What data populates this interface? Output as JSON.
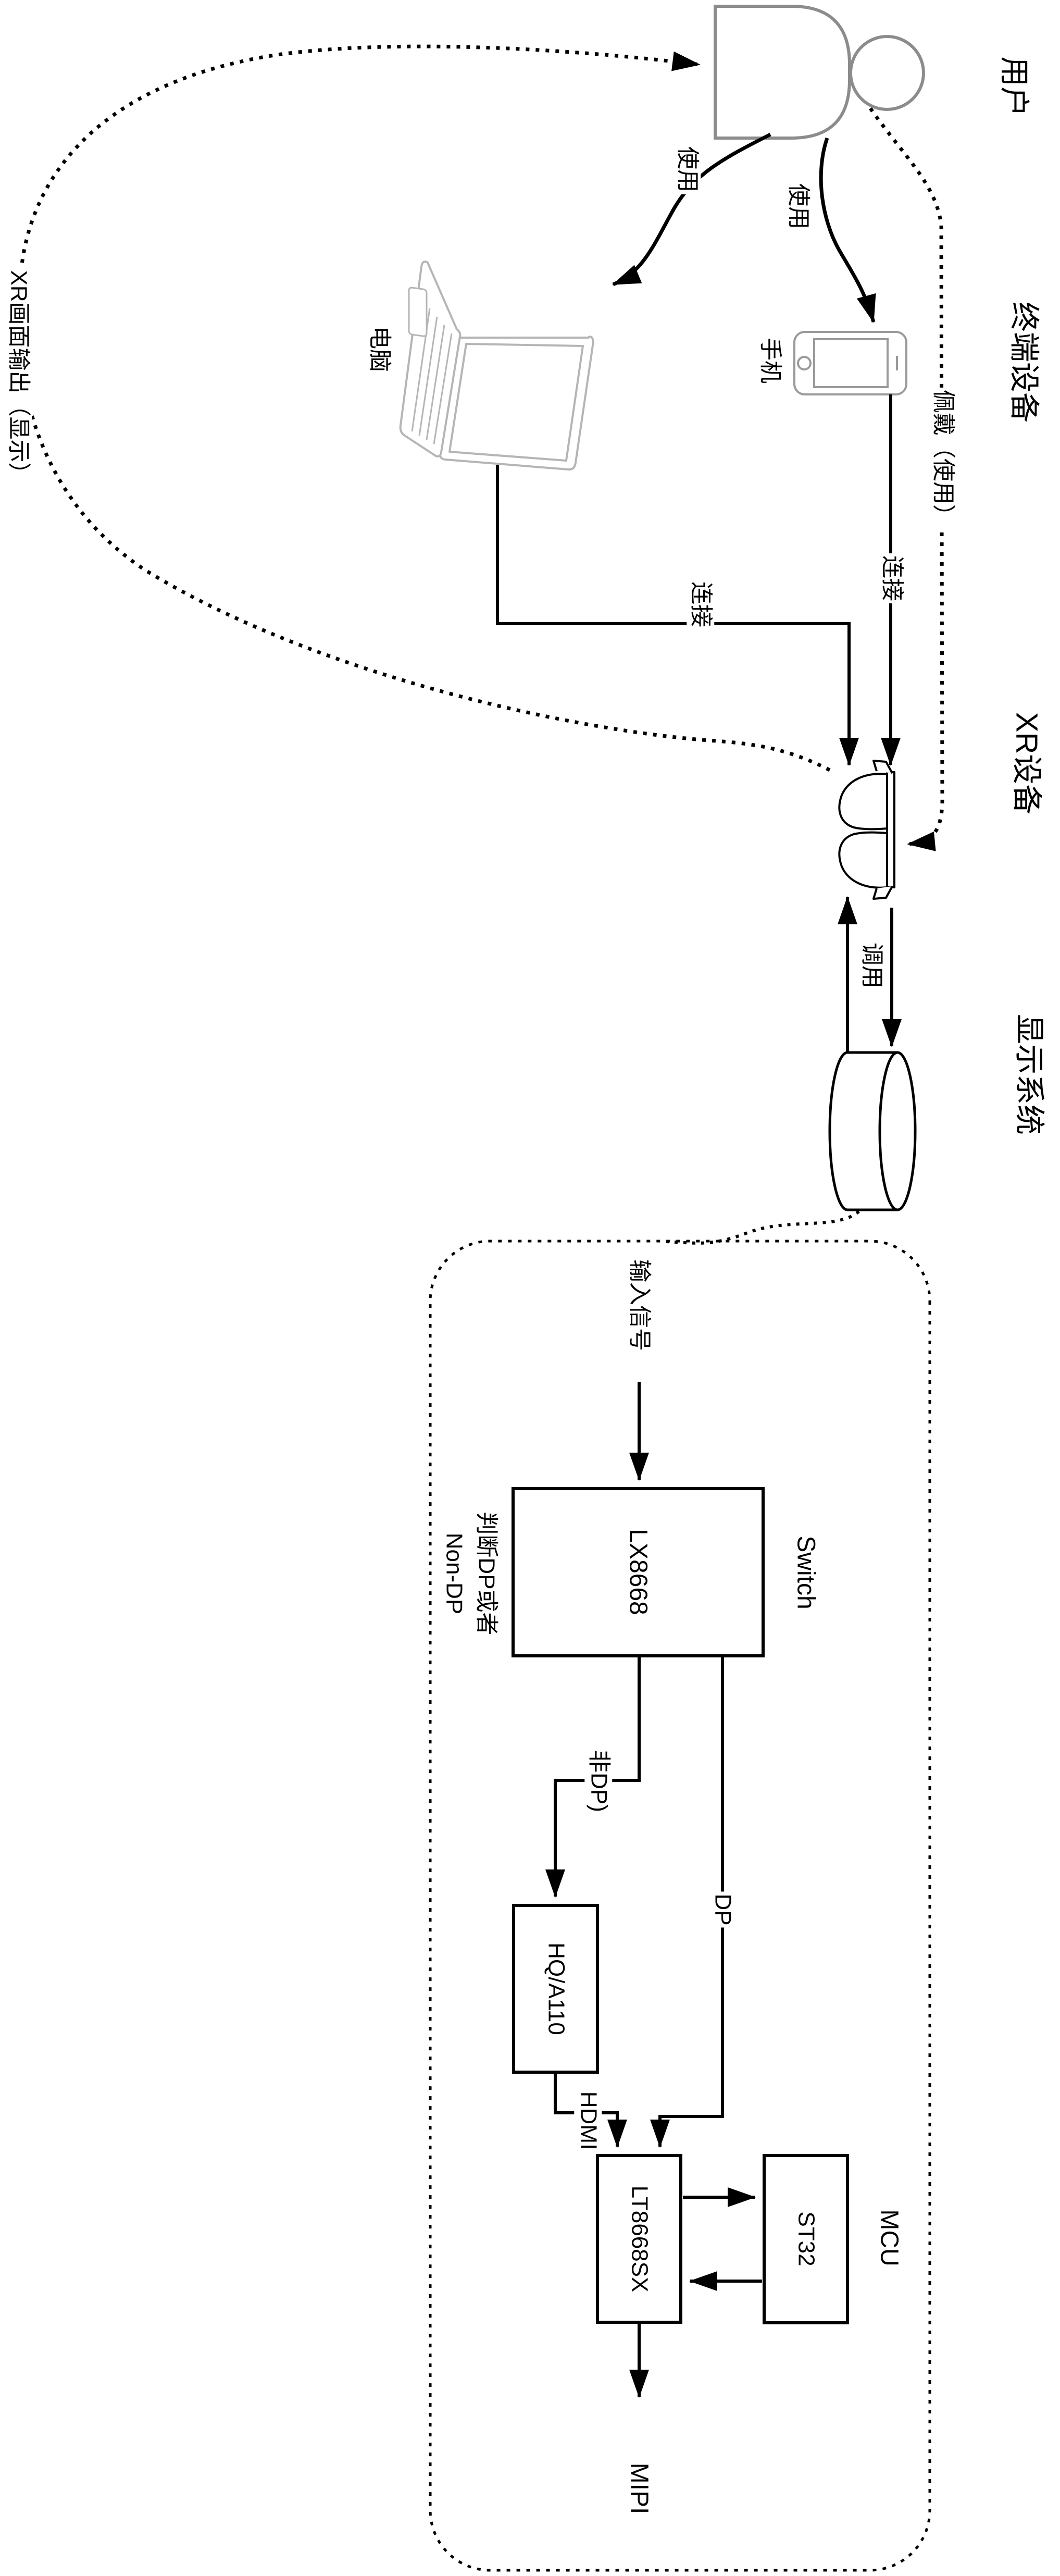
{
  "labels": {
    "lane_user": "用户",
    "lane_terminal": "终端设备",
    "lane_xr": "XR设备",
    "lane_display": "显示系统",
    "pc": "电脑",
    "phone": "手机",
    "use_pc": "使用",
    "use_phone": "使用",
    "wear": "佩戴（使用）",
    "connect_pc": "连接",
    "connect_phone": "连接",
    "invoke": "调用",
    "xr_output": "XR画面输出（显示）",
    "input_signal": "输入信号",
    "switch_chip": "LX8668",
    "switch_role": "Switch",
    "judge_line1": "判断DP或者",
    "judge_line2": "Non-DP",
    "non_dp_edge": "非DP)",
    "dp_edge": "DP",
    "converter": "HQ/A110",
    "hdmi_edge": "HDMI",
    "bridge_chip": "LT8668SX",
    "mcu_chip": "ST32",
    "mcu_role": "MCU",
    "mipi_edge": "MIPI"
  },
  "colors": {
    "line": "#000000",
    "actor_gray": "#8c8c8c",
    "laptop_gray": "#b5b5b5",
    "phone_gray": "#9a9a9a",
    "background": "#ffffff"
  }
}
